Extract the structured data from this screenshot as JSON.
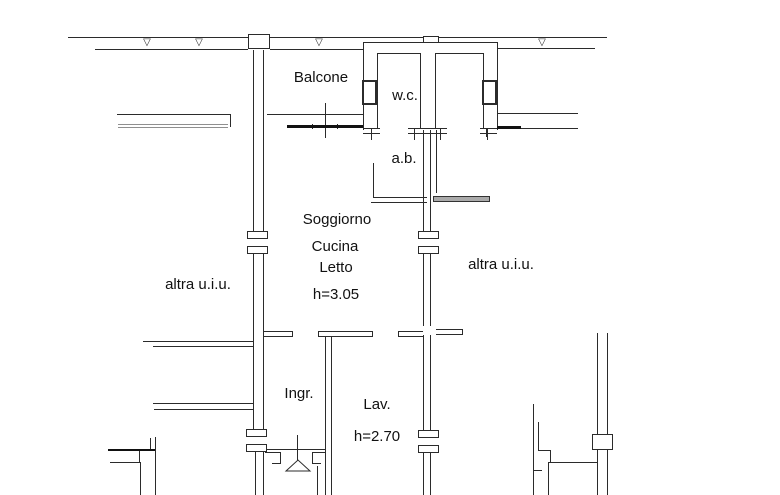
{
  "drawing": {
    "type": "cadastral-floor-plan",
    "rooms": {
      "balcone": "Balcone",
      "wc": "w.c.",
      "ab": "a.b.",
      "soggiorno_line1": "Soggiorno",
      "soggiorno_line2": "Cucina",
      "soggiorno_line3": "Letto",
      "soggiorno_height": "h=3.05",
      "altra_uiu_left": "altra u.i.u.",
      "altra_uiu_right": "altra u.i.u.",
      "ingresso": "Ingr.",
      "lavanderia": "Lav.",
      "lav_height": "h=2.70"
    },
    "icons": {
      "balcony_post": "▽"
    },
    "colors": {
      "line": "#2b2b2b",
      "dark_edge": "#111111",
      "gray_parapet": "#8f8f8f",
      "background": "#ffffff",
      "text": "#111111"
    }
  }
}
